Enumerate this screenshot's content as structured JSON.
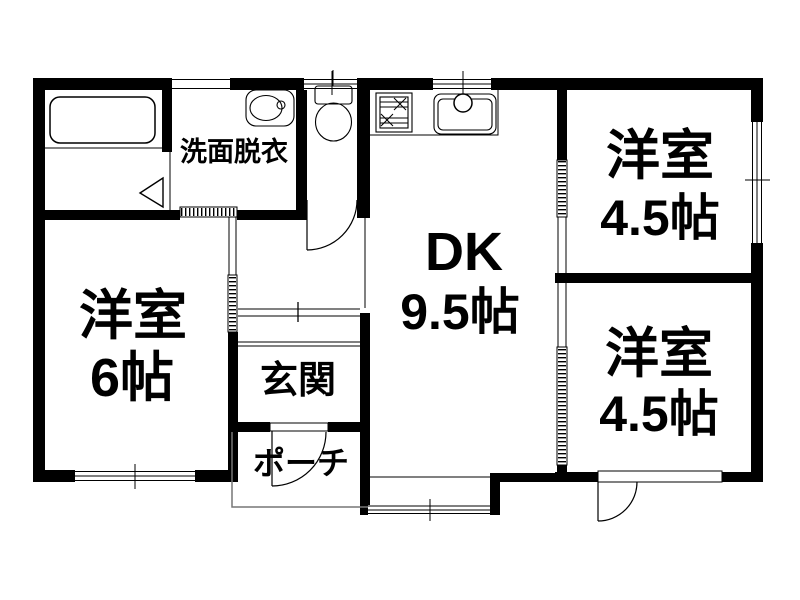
{
  "floorplan": {
    "type": "japanese-apartment-floorplan",
    "colors": {
      "wall": "#000000",
      "background": "#ffffff",
      "porch_outline": "#777777"
    },
    "rooms": {
      "washroom": {
        "label": "洗面脱衣"
      },
      "dining_kitchen": {
        "label": "DK",
        "size": "9.5帖"
      },
      "bedroom_top_right": {
        "label": "洋室",
        "size": "4.5帖"
      },
      "bedroom_bottom_right": {
        "label": "洋室",
        "size": "4.5帖"
      },
      "bedroom_left": {
        "label": "洋室",
        "size": "6帖"
      },
      "entrance": {
        "label": "玄関"
      },
      "porch": {
        "label": "ポーチ"
      }
    },
    "fixtures": [
      "bathtub",
      "vanity-sink",
      "toilet",
      "gas-stove",
      "kitchen-sink"
    ]
  }
}
